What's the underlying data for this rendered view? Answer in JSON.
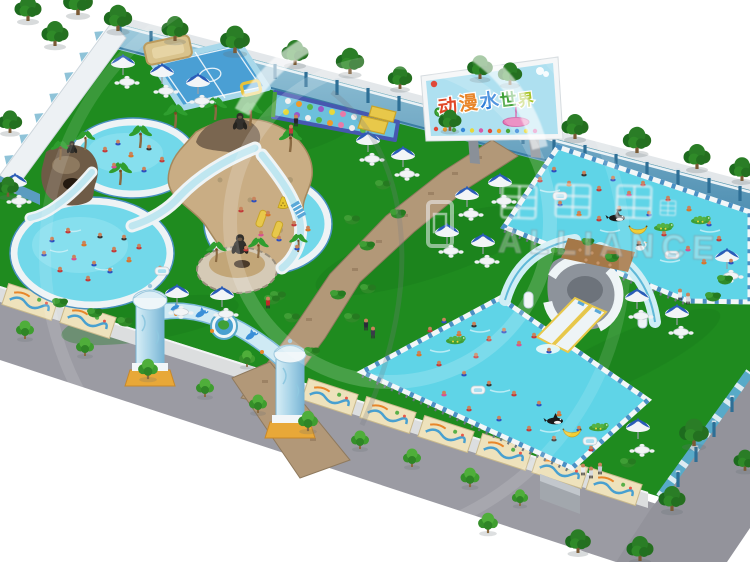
{
  "billboard": {
    "title": "动漫水世界",
    "chars": [
      "动",
      "漫",
      "水",
      "世",
      "界"
    ],
    "colors": [
      "#e04828",
      "#e8862a",
      "#2e7fd8",
      "#3fa038",
      "#a8c428"
    ]
  },
  "watermark": {
    "text_en": "ALLIANCE"
  },
  "palette": {
    "grass": "#1f8b1f",
    "pool_water": "#72d8ea",
    "frame_pool_water": "#5fd4e7",
    "path_brick": "#b29878",
    "wall_blue": "#74aecb",
    "billboard_sky": "#aee0f0",
    "umbrella_blue": "#2a5cb8",
    "accent_yellow": "#e8c52f",
    "walkway_gray": "#9b9ba3"
  },
  "stamps": [
    {
      "symbol": "post",
      "layer": "wall-posts",
      "items": [
        [
          120,
          24
        ],
        [
          151,
          32
        ],
        [
          182,
          40
        ],
        [
          213,
          49
        ],
        [
          244,
          57
        ],
        [
          275,
          65
        ],
        [
          306,
          73
        ],
        [
          337,
          81
        ],
        [
          368,
          89
        ],
        [
          399,
          97
        ],
        [
          430,
          106
        ],
        [
          461,
          114
        ],
        [
          492,
          122
        ],
        [
          523,
          130
        ],
        [
          554,
          138
        ],
        [
          585,
          146
        ],
        [
          616,
          155
        ],
        [
          647,
          163
        ],
        [
          678,
          171
        ],
        [
          709,
          179
        ],
        [
          740,
          187
        ]
      ]
    },
    {
      "symbol": "post",
      "layer": "east-fence-posts",
      "items": [
        [
          678,
          473
        ],
        [
          696,
          448
        ],
        [
          714,
          423
        ],
        [
          732,
          398
        ]
      ]
    },
    {
      "symbol": "tri",
      "layer": "nw-scallops",
      "items": [
        [
          100,
          36,
          1,
          -54
        ],
        [
          85,
          57,
          1,
          -54
        ],
        [
          70,
          77,
          1,
          -54
        ],
        [
          55,
          98,
          1,
          -54
        ],
        [
          40,
          118,
          1,
          -54
        ],
        [
          25,
          139,
          1,
          -54
        ],
        [
          10,
          160,
          1,
          -54
        ]
      ]
    },
    {
      "symbol": "mural",
      "layer": "fence-murals",
      "items": [
        [
          30,
          302,
          1,
          18
        ],
        [
          88,
          320,
          1,
          18
        ],
        [
          330,
          397,
          1,
          18
        ],
        [
          388,
          415,
          1,
          18
        ],
        [
          446,
          434,
          1,
          18
        ],
        [
          504,
          452,
          1,
          18
        ],
        [
          560,
          470,
          1,
          18
        ],
        [
          614,
          487,
          1,
          18
        ]
      ]
    },
    {
      "symbol": "palm",
      "layer": "cluster-top",
      "items": [
        [
          120,
          185,
          1
        ],
        [
          140,
          148,
          1
        ],
        [
          175,
          128,
          1.05
        ],
        [
          215,
          120,
          1
        ],
        [
          250,
          126,
          1.05
        ],
        [
          290,
          152,
          1
        ],
        [
          216,
          262,
          0.9
        ],
        [
          258,
          258,
          0.9
        ],
        [
          60,
          160,
          0.85
        ],
        [
          85,
          150,
          0.85
        ],
        [
          298,
          252,
          0.8
        ]
      ]
    },
    {
      "symbol": "gorilla",
      "layer": "cluster-top",
      "items": [
        [
          240,
          128,
          1.1
        ],
        [
          240,
          252,
          1.3
        ],
        [
          72,
          152,
          0.8
        ]
      ]
    },
    {
      "symbol": "swimmer",
      "layer": "layer-water-items",
      "items": [
        [
          105,
          150,
          "#c23a3a"
        ],
        [
          118,
          143,
          "#2c4fc0"
        ],
        [
          131,
          155,
          "#d8762a"
        ],
        [
          149,
          148,
          "#343434"
        ],
        [
          162,
          160,
          "#c23a3a"
        ],
        [
          144,
          170,
          "#2c4fc0"
        ],
        [
          114,
          166,
          "#d84f95"
        ],
        [
          52,
          240,
          "#2c4fc0"
        ],
        [
          68,
          231,
          "#c23a3a"
        ],
        [
          84,
          244,
          "#d8762a"
        ],
        [
          100,
          236,
          "#343434"
        ],
        [
          114,
          250,
          "#c23a3a"
        ],
        [
          94,
          264,
          "#2c4fc0"
        ],
        [
          74,
          258,
          "#d84f95"
        ],
        [
          60,
          270,
          "#c23a3a"
        ],
        [
          110,
          271,
          "#2c4fc0"
        ],
        [
          129,
          260,
          "#d8762a"
        ],
        [
          139,
          247,
          "#c23a3a"
        ],
        [
          124,
          238,
          "#343434"
        ],
        [
          44,
          254,
          "#2c4fc0"
        ],
        [
          88,
          279,
          "#c23a3a"
        ],
        [
          160,
          269,
          "#d8762a"
        ],
        [
          241,
          210,
          "#c23a3a"
        ],
        [
          254,
          200,
          "#2c4fc0"
        ],
        [
          268,
          214,
          "#d8762a"
        ],
        [
          284,
          206,
          "#343434"
        ],
        [
          294,
          224,
          "#c23a3a"
        ],
        [
          279,
          239,
          "#2c4fc0"
        ],
        [
          261,
          234,
          "#d84f95"
        ],
        [
          246,
          249,
          "#c23a3a"
        ],
        [
          297,
          248,
          "#2c4fc0"
        ],
        [
          308,
          229,
          "#d8762a"
        ],
        [
          540,
          180,
          "#c23a3a"
        ],
        [
          554,
          170,
          "#2c4fc0"
        ],
        [
          569,
          184,
          "#d8762a"
        ],
        [
          584,
          174,
          "#343434"
        ],
        [
          599,
          189,
          "#c23a3a"
        ],
        [
          613,
          179,
          "#2c4fc0"
        ],
        [
          629,
          194,
          "#d84f95"
        ],
        [
          643,
          184,
          "#c23a3a"
        ],
        [
          560,
          204,
          "#2c4fc0"
        ],
        [
          579,
          214,
          "#d8762a"
        ],
        [
          599,
          219,
          "#c23a3a"
        ],
        [
          619,
          209,
          "#343434"
        ],
        [
          649,
          214,
          "#2c4fc0"
        ],
        [
          668,
          199,
          "#c23a3a"
        ],
        [
          689,
          209,
          "#d8762a"
        ],
        [
          709,
          224,
          "#2c4fc0"
        ],
        [
          664,
          234,
          "#c23a3a"
        ],
        [
          639,
          244,
          "#343434"
        ],
        [
          688,
          249,
          "#d84f95"
        ],
        [
          719,
          239,
          "#c23a3a"
        ],
        [
          731,
          262,
          "#2c4fc0"
        ],
        [
          704,
          262,
          "#d8762a"
        ],
        [
          430,
          330,
          "#c23a3a"
        ],
        [
          444,
          321,
          "#2c4fc0"
        ],
        [
          459,
          334,
          "#d8762a"
        ],
        [
          474,
          325,
          "#343434"
        ],
        [
          489,
          339,
          "#c23a3a"
        ],
        [
          504,
          331,
          "#2c4fc0"
        ],
        [
          519,
          344,
          "#d84f95"
        ],
        [
          534,
          336,
          "#c23a3a"
        ],
        [
          549,
          351,
          "#2c4fc0"
        ],
        [
          419,
          354,
          "#d8762a"
        ],
        [
          439,
          364,
          "#c23a3a"
        ],
        [
          464,
          374,
          "#2c4fc0"
        ],
        [
          489,
          384,
          "#343434"
        ],
        [
          514,
          394,
          "#c23a3a"
        ],
        [
          539,
          404,
          "#2c4fc0"
        ],
        [
          559,
          414,
          "#d8762a"
        ],
        [
          469,
          409,
          "#c23a3a"
        ],
        [
          444,
          394,
          "#d84f95"
        ],
        [
          499,
          419,
          "#2c4fc0"
        ],
        [
          529,
          429,
          "#c23a3a"
        ],
        [
          554,
          439,
          "#343434"
        ],
        [
          579,
          429,
          "#2c4fc0"
        ],
        [
          591,
          449,
          "#c23a3a"
        ],
        [
          476,
          356,
          "#c23a3a"
        ]
      ]
    },
    {
      "symbol": "raft",
      "layer": "layer-water-items",
      "items": [
        [
          162,
          271
        ],
        [
          560,
          196
        ],
        [
          672,
          255
        ],
        [
          478,
          390
        ],
        [
          590,
          441
        ]
      ]
    },
    {
      "symbol": "orca",
      "layer": "layer-water-items",
      "items": [
        [
          617,
          218
        ],
        [
          555,
          421
        ]
      ]
    },
    {
      "symbol": "banana",
      "layer": "layer-water-items",
      "items": [
        [
          638,
          228
        ],
        [
          572,
          431
        ]
      ]
    },
    {
      "symbol": "boat",
      "layer": "layer-water-items",
      "items": [
        [
          663,
          228
        ],
        [
          700,
          221
        ],
        [
          455,
          341
        ],
        [
          598,
          428
        ]
      ]
    },
    {
      "symbol": "swan",
      "layer": "layer-water-items",
      "items": [
        [
          640,
          248
        ]
      ]
    },
    {
      "symbol": "cone",
      "layer": "layer-water-items",
      "items": [
        [
          283,
          204
        ]
      ]
    },
    {
      "symbol": "umbrella",
      "layer": "layer-furniture",
      "items": [
        [
          15,
          192
        ],
        [
          123,
          73
        ],
        [
          162,
          82
        ],
        [
          198,
          92
        ],
        [
          368,
          150
        ],
        [
          403,
          165
        ],
        [
          500,
          192
        ],
        [
          467,
          205
        ],
        [
          447,
          242
        ],
        [
          483,
          252
        ],
        [
          177,
          303
        ],
        [
          222,
          305
        ],
        [
          637,
          307
        ],
        [
          677,
          323
        ],
        [
          727,
          267
        ],
        [
          638,
          437
        ]
      ]
    },
    {
      "symbol": "table",
      "layer": "layer-furniture",
      "items": [
        [
          127,
          82
        ],
        [
          166,
          91
        ],
        [
          202,
          101
        ],
        [
          372,
          159
        ],
        [
          407,
          174
        ],
        [
          471,
          214
        ],
        [
          451,
          251
        ],
        [
          487,
          261
        ],
        [
          181,
          312
        ],
        [
          226,
          314
        ],
        [
          641,
          316
        ],
        [
          681,
          332
        ],
        [
          731,
          276
        ],
        [
          642,
          450
        ],
        [
          19,
          201
        ],
        [
          504,
          201
        ]
      ]
    },
    {
      "symbol": "bush",
      "layer": "layer-green",
      "items": [
        [
          278,
          296
        ],
        [
          292,
          318
        ],
        [
          312,
          352
        ],
        [
          338,
          295
        ],
        [
          352,
          318
        ],
        [
          368,
          289
        ],
        [
          383,
          185
        ],
        [
          352,
          220
        ],
        [
          367,
          246
        ],
        [
          398,
          214
        ],
        [
          60,
          303
        ],
        [
          95,
          313
        ],
        [
          125,
          322
        ],
        [
          272,
          300
        ],
        [
          628,
          463
        ],
        [
          725,
          280
        ],
        [
          713,
          297
        ],
        [
          558,
          252,
          0.9
        ],
        [
          612,
          258,
          0.9
        ],
        [
          588,
          242,
          0.8
        ]
      ]
    },
    {
      "symbol": "treeSmall",
      "layer": "layer-green",
      "items": [
        [
          25,
          338,
          1
        ],
        [
          85,
          355,
          1
        ],
        [
          148,
          378,
          1.1
        ],
        [
          205,
          396,
          1
        ],
        [
          258,
          412,
          1
        ],
        [
          308,
          430,
          1.1
        ],
        [
          360,
          448,
          1
        ],
        [
          412,
          466,
          1
        ],
        [
          470,
          486,
          1.05
        ],
        [
          488,
          532,
          1.1
        ],
        [
          520,
          505,
          0.9
        ],
        [
          247,
          366,
          0.9
        ]
      ]
    },
    {
      "symbol": "tree",
      "layer": "layer-green",
      "items": [
        [
          28,
          20,
          1
        ],
        [
          78,
          14,
          1.1
        ],
        [
          10,
          132,
          0.9
        ],
        [
          8,
          196,
          0.8
        ],
        [
          55,
          45,
          1
        ],
        [
          118,
          30,
          1.05
        ],
        [
          175,
          40,
          1
        ],
        [
          235,
          52,
          1.1
        ],
        [
          295,
          64,
          1
        ],
        [
          350,
          73,
          1.05
        ],
        [
          400,
          88,
          0.9
        ],
        [
          480,
          78,
          0.95
        ],
        [
          510,
          84,
          0.9
        ],
        [
          575,
          138,
          1
        ],
        [
          637,
          152,
          1.05
        ],
        [
          697,
          168,
          1
        ],
        [
          742,
          180,
          0.95
        ],
        [
          450,
          130,
          0.85
        ],
        [
          694,
          445,
          1.1
        ],
        [
          672,
          510,
          1
        ],
        [
          640,
          560,
          1
        ],
        [
          578,
          552,
          0.95
        ],
        [
          745,
          470,
          0.85
        ]
      ]
    },
    {
      "symbol": "dolphin",
      "layer": "arch-deco",
      "items": [
        [
          202,
          314,
          1,
          -12
        ],
        [
          252,
          336,
          1,
          -15
        ],
        [
          176,
          308,
          0.8,
          -8
        ]
      ]
    },
    {
      "symbol": "stander",
      "layer": "layer-people",
      "items": [
        [
          296,
          126,
          "#26262c"
        ],
        [
          291,
          136,
          "#c23a3a"
        ],
        [
          268,
          308,
          "#c22828"
        ],
        [
          366,
          330,
          "#2a2a3a"
        ],
        [
          373,
          338,
          "#3a3a4a"
        ],
        [
          583,
          475,
          "#e8eaec"
        ],
        [
          591,
          478,
          "#d8dce0"
        ],
        [
          600,
          474,
          "#c8ccd4"
        ],
        [
          680,
          300,
          "#e8eaec"
        ],
        [
          688,
          304,
          "#d8dce0"
        ]
      ]
    },
    {
      "symbol": "glyph",
      "layer": "watermark-glyphs",
      "items": [
        [
          519,
          202,
          1,
          2
        ],
        [
          573,
          201,
          1,
          2
        ],
        [
          634,
          202,
          1,
          2
        ],
        [
          668,
          208,
          0.45,
          2
        ]
      ]
    }
  ]
}
